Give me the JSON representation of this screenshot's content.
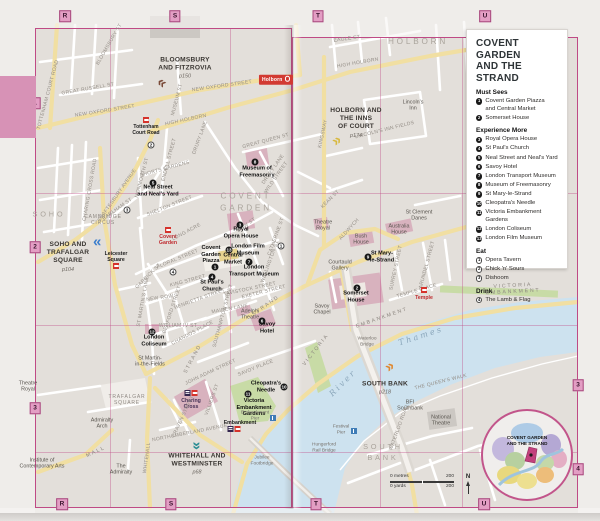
{
  "legend": {
    "title": "COVENT GARDEN\nAND THE STRAND",
    "sections": [
      {
        "heading": "Must Sees",
        "marker_style": "filled",
        "items": [
          {
            "num": "1",
            "label": "Covent Garden Piazza\nand Central Market"
          },
          {
            "num": "2",
            "label": "Somerset House"
          }
        ]
      },
      {
        "heading": "Experience More",
        "marker_style": "filled",
        "items": [
          {
            "num": "3",
            "label": "Royal Opera House"
          },
          {
            "num": "4",
            "label": "St Paul's Church"
          },
          {
            "num": "5",
            "label": "Neal Street and Neal's Yard"
          },
          {
            "num": "6",
            "label": "Savoy Hotel"
          },
          {
            "num": "7",
            "label": "London Transport Museum"
          },
          {
            "num": "8",
            "label": "Museum of Freemasonry"
          },
          {
            "num": "9",
            "label": "St Mary-le-Strand"
          },
          {
            "num": "10",
            "label": "Cleopatra's Needle"
          },
          {
            "num": "11",
            "label": "Victoria Embankment Gardens"
          },
          {
            "num": "12",
            "label": "London Coliseum"
          },
          {
            "num": "13",
            "label": "London Film Museum"
          }
        ]
      },
      {
        "heading": "Eat",
        "marker_style": "outline",
        "items": [
          {
            "num": "1",
            "label": "Opera Tavern"
          },
          {
            "num": "2",
            "label": "Chick 'n' Sours"
          },
          {
            "num": "3",
            "label": "Dishoom"
          }
        ]
      },
      {
        "heading": "Drink",
        "marker_style": "outline",
        "items": [
          {
            "num": "4",
            "label": "The Lamb & Flag"
          }
        ]
      }
    ]
  },
  "scale": {
    "metres_label": "0 metres",
    "metres_value": "200",
    "yards_label": "0 yards",
    "yards_value": "200",
    "north_label": "N"
  },
  "inset": {
    "label": "COVENT GARDEN\nAND THE STRAND"
  },
  "colors": {
    "grid_pink": "#bf4a85",
    "marker_pink": "#e39ec4",
    "river_blue": "#cde2ef",
    "road_yellow": "#f1dfa2",
    "park_green": "#c8dba6",
    "building_pink": "#d7aebc"
  },
  "grid_markers": [
    {
      "label": "R",
      "x": 65,
      "y": 16
    },
    {
      "label": "S",
      "x": 175,
      "y": 16
    },
    {
      "label": "T",
      "x": 318,
      "y": 16
    },
    {
      "label": "U",
      "x": 485,
      "y": 16
    },
    {
      "label": "R",
      "x": 62,
      "y": 504
    },
    {
      "label": "S",
      "x": 171,
      "y": 504
    },
    {
      "label": "T",
      "x": 316,
      "y": 504
    },
    {
      "label": "U",
      "x": 484,
      "y": 504
    },
    {
      "label": "1",
      "x": 35,
      "y": 103
    },
    {
      "label": "2",
      "x": 35,
      "y": 247
    },
    {
      "label": "3",
      "x": 35,
      "y": 408
    },
    {
      "label": "3",
      "x": 578,
      "y": 385
    },
    {
      "label": "4",
      "x": 578,
      "y": 469
    }
  ],
  "chapters": [
    {
      "title": "BLOOMSBURY\nAND FITZROVIA",
      "page": "p150",
      "x": 185,
      "y": 68,
      "arrow": {
        "x": 162,
        "y": 84,
        "rot": -145,
        "color": "#7a4a38"
      }
    },
    {
      "title": "HOLBORN AND\nTHE INNS\nOF COURT",
      "page": "p174",
      "x": 356,
      "y": 123,
      "arrow": {
        "x": 336,
        "y": 141,
        "rot": -35,
        "color": "#d8b93f"
      }
    },
    {
      "title": "SOHO AND\nTRAFALGAR\nSQUARE",
      "page": "p104",
      "x": 68,
      "y": 257,
      "arrow": {
        "x": 98,
        "y": 243,
        "rot": 180,
        "color": "#3b7ecd"
      }
    },
    {
      "title": "WHITEHALL AND\nWESTMINSTER",
      "page": "p68",
      "x": 197,
      "y": 464,
      "arrow": {
        "x": 197,
        "y": 445,
        "rot": 90,
        "color": "#2b8d94"
      }
    },
    {
      "title": "SOUTH BANK",
      "page": "p218",
      "x": 385,
      "y": 388,
      "arrow": {
        "x": 389,
        "y": 367,
        "rot": -35,
        "color": "#df8830"
      }
    }
  ],
  "markers": [
    {
      "num": "1",
      "kind": "sight",
      "x": 215,
      "y": 267
    },
    {
      "num": "2",
      "kind": "sight",
      "x": 357,
      "y": 288
    },
    {
      "num": "3",
      "kind": "sight",
      "x": 240,
      "y": 225
    },
    {
      "num": "4",
      "kind": "sight",
      "x": 212,
      "y": 277
    },
    {
      "num": "5",
      "kind": "sight",
      "x": 153,
      "y": 183
    },
    {
      "num": "6",
      "kind": "sight",
      "x": 262,
      "y": 321
    },
    {
      "num": "7",
      "kind": "sight",
      "x": 249,
      "y": 262
    },
    {
      "num": "8",
      "kind": "sight",
      "x": 255,
      "y": 162
    },
    {
      "num": "9",
      "kind": "sight",
      "x": 368,
      "y": 257
    },
    {
      "num": "10",
      "kind": "sight",
      "x": 284,
      "y": 387
    },
    {
      "num": "11",
      "kind": "sight",
      "x": 248,
      "y": 394
    },
    {
      "num": "12",
      "kind": "sight",
      "x": 152,
      "y": 332
    },
    {
      "num": "13",
      "kind": "sight",
      "x": 229,
      "y": 250
    },
    {
      "num": "1",
      "kind": "eat",
      "x": 281,
      "y": 246
    },
    {
      "num": "2",
      "kind": "eat",
      "x": 151,
      "y": 145
    },
    {
      "num": "3",
      "kind": "eat",
      "x": 127,
      "y": 210
    },
    {
      "num": "4",
      "kind": "eat",
      "x": 173,
      "y": 272
    }
  ],
  "station_icons": [
    {
      "x": 146,
      "y": 120,
      "types": [
        "tube"
      ],
      "name": "tottenham-court-road-station"
    },
    {
      "x": 168,
      "y": 230,
      "types": [
        "tube"
      ],
      "name": "covent-garden-station"
    },
    {
      "x": 116,
      "y": 266,
      "types": [
        "tube"
      ],
      "name": "leicester-square-station"
    },
    {
      "x": 191,
      "y": 393,
      "types": [
        "rail",
        "tube"
      ],
      "name": "charing-cross-station"
    },
    {
      "x": 234,
      "y": 429,
      "types": [
        "rail",
        "tube"
      ],
      "name": "embankment-station"
    },
    {
      "x": 273,
      "y": 418,
      "types": [
        "pier"
      ],
      "name": "embankment-pier-icon"
    },
    {
      "x": 424,
      "y": 290,
      "types": [
        "tube"
      ],
      "name": "temple-station"
    },
    {
      "x": 354,
      "y": 431,
      "types": [
        "pier"
      ],
      "name": "festival-pier-icon"
    }
  ],
  "labels": [
    {
      "text": "SOHO",
      "x": 49,
      "y": 214,
      "cls": "area area-sm",
      "name": "area-label-soho"
    },
    {
      "text": "COVENT\nGARDEN",
      "x": 246,
      "y": 203,
      "cls": "area",
      "name": "area-label-covent-garden"
    },
    {
      "text": "HOLBORN",
      "x": 418,
      "y": 42,
      "cls": "area",
      "name": "area-label-holborn"
    },
    {
      "text": "SOUTH\nBANK",
      "x": 383,
      "y": 452,
      "cls": "area area-sm",
      "name": "area-label-south-bank"
    },
    {
      "text": "River",
      "x": 343,
      "y": 383,
      "cls": "river",
      "rot": -45,
      "name": "river-label"
    },
    {
      "text": "Thames",
      "x": 421,
      "y": 336,
      "cls": "river",
      "rot": -18,
      "name": "river-label"
    },
    {
      "text": "Covent\nGarden\nPiazza",
      "x": 211,
      "y": 255,
      "cls": "sight"
    },
    {
      "text": "Central\nMarket",
      "x": 233,
      "y": 259,
      "cls": "sight"
    },
    {
      "text": "Somerset\nHouse",
      "x": 356,
      "y": 297,
      "cls": "sight"
    },
    {
      "text": "Royal\nOpera House",
      "x": 241,
      "y": 233,
      "cls": "sight"
    },
    {
      "text": "St Paul's\nChurch",
      "x": 212,
      "y": 286,
      "cls": "sight"
    },
    {
      "text": "Neal Street\nand Neal's Yard",
      "x": 158,
      "y": 191,
      "cls": "sight"
    },
    {
      "text": "Savoy\nHotel",
      "x": 267,
      "y": 328,
      "cls": "sight"
    },
    {
      "text": "London\nTransport Museum",
      "x": 254,
      "y": 271,
      "cls": "sight"
    },
    {
      "text": "Museum of\nFreemasonry",
      "x": 257,
      "y": 172,
      "cls": "sight"
    },
    {
      "text": "St Mary-\nle-Strand",
      "x": 382,
      "y": 257,
      "cls": "sight"
    },
    {
      "text": "Cleopatra's\nNeedle",
      "x": 266,
      "y": 387,
      "cls": "sight"
    },
    {
      "text": "Victoria\nEmbankment\nGardens",
      "x": 254,
      "y": 408,
      "cls": "sight"
    },
    {
      "text": "London\nColiseum",
      "x": 154,
      "y": 341,
      "cls": "sight"
    },
    {
      "text": "London Film\nMuseum",
      "x": 248,
      "y": 250,
      "cls": "sight"
    },
    {
      "text": "Holborn",
      "x": 276,
      "y": 80,
      "cls": "tube-badge",
      "name": "holborn-station"
    },
    {
      "text": "Tottenham\nCourt Road",
      "x": 146,
      "y": 131,
      "cls": "station",
      "size": 5
    },
    {
      "text": "Covent\nGarden",
      "x": 168,
      "y": 240,
      "cls": "station station-red"
    },
    {
      "text": "Leicester\nSquare",
      "x": 116,
      "y": 257,
      "cls": "station"
    },
    {
      "text": "Charing\nCross",
      "x": 191,
      "y": 404,
      "cls": "station station-purple"
    },
    {
      "text": "Embankment",
      "x": 240,
      "y": 423,
      "cls": "station"
    },
    {
      "text": "Embankment\nPier",
      "x": 255,
      "y": 416,
      "cls": "pier-lbl"
    },
    {
      "text": "Temple",
      "x": 424,
      "y": 298,
      "cls": "station station-red"
    },
    {
      "text": "Festival\nPier",
      "x": 341,
      "y": 430,
      "cls": "pier-lbl"
    },
    {
      "text": "Waterloo\nBridge",
      "x": 367,
      "y": 342,
      "cls": "pier-lbl"
    },
    {
      "text": "Jubilee\nFootbridge",
      "x": 262,
      "y": 461,
      "cls": "pier-lbl"
    },
    {
      "text": "Hungerford\nRail Bridge",
      "x": 324,
      "y": 448,
      "cls": "pier-lbl"
    },
    {
      "text": "Lincoln's\nInn",
      "x": 413,
      "y": 106,
      "cls": "poi"
    },
    {
      "text": "St Clement\nDanes",
      "x": 419,
      "y": 216,
      "cls": "poi"
    },
    {
      "text": "Theatre\nRoyal",
      "x": 323,
      "y": 226,
      "cls": "poi"
    },
    {
      "text": "Bush\nHouse",
      "x": 361,
      "y": 240,
      "cls": "poi"
    },
    {
      "text": "Australia\nHouse",
      "x": 399,
      "y": 230,
      "cls": "poi"
    },
    {
      "text": "Courtauld\nGallery",
      "x": 340,
      "y": 266,
      "cls": "poi"
    },
    {
      "text": "Savoy\nChapel",
      "x": 322,
      "y": 310,
      "cls": "poi"
    },
    {
      "text": "Adelphi\nTheatre",
      "x": 250,
      "y": 315,
      "cls": "poi"
    },
    {
      "text": "St Martin-\nin-the-Fields",
      "x": 150,
      "y": 362,
      "cls": "poi"
    },
    {
      "text": "Admiralty\nArch",
      "x": 102,
      "y": 424,
      "cls": "poi"
    },
    {
      "text": "The\nAdmiralty",
      "x": 121,
      "y": 470,
      "cls": "poi"
    },
    {
      "text": "Institute of\nContemporary Arts",
      "x": 42,
      "y": 464,
      "cls": "poi"
    },
    {
      "text": "Theatre\nRoyal",
      "x": 28,
      "y": 387,
      "cls": "poi"
    },
    {
      "text": "BFI\nSouthbank",
      "x": 410,
      "y": 406,
      "cls": "poi"
    },
    {
      "text": "National\nTheatre",
      "x": 441,
      "y": 421,
      "cls": "poi"
    },
    {
      "text": "TRAFALGAR\nSQUARE",
      "x": 127,
      "y": 401,
      "cls": "poi-caps"
    },
    {
      "text": "CAMBRIDGE\nCIRCUS",
      "x": 103,
      "y": 221,
      "cls": "poi-caps"
    },
    {
      "text": "NEW OXFORD STREET",
      "x": 105,
      "y": 112,
      "cls": "street",
      "rot": -9
    },
    {
      "text": "NEW OXFORD STREET",
      "x": 222,
      "y": 87,
      "cls": "street",
      "rot": -8
    },
    {
      "text": "HIGH HOLBORN",
      "x": 186,
      "y": 121,
      "cls": "street",
      "rot": -12
    },
    {
      "text": "HIGH HOLBORN",
      "x": 358,
      "y": 64,
      "cls": "street",
      "rot": -10
    },
    {
      "text": "TOTTENHAM COURT ROAD",
      "x": 49,
      "y": 95,
      "cls": "street",
      "rot": -75
    },
    {
      "text": "BLOOMSBURY ST",
      "x": 110,
      "y": 45,
      "cls": "street",
      "rot": -60
    },
    {
      "text": "GREAT RUSSELL ST",
      "x": 88,
      "y": 90,
      "cls": "street",
      "rot": -10
    },
    {
      "text": "MUSEUM ST",
      "x": 178,
      "y": 100,
      "cls": "street",
      "rot": -75
    },
    {
      "text": "SHAFTESBURY AVENUE",
      "x": 118,
      "y": 196,
      "cls": "street",
      "rot": -55
    },
    {
      "text": "CHARING CROSS ROAD",
      "x": 91,
      "y": 190,
      "cls": "street",
      "rot": -80
    },
    {
      "text": "EARLHAM ST",
      "x": 118,
      "y": 210,
      "cls": "street",
      "rot": -35
    },
    {
      "text": "MONMOUTH ST",
      "x": 143,
      "y": 178,
      "cls": "street",
      "rot": -75
    },
    {
      "text": "ENDELL STREET",
      "x": 170,
      "y": 160,
      "cls": "street",
      "rot": -75
    },
    {
      "text": "DRURY LANE",
      "x": 201,
      "y": 138,
      "cls": "street",
      "rot": -70
    },
    {
      "text": "DRURY LANE",
      "x": 274,
      "y": 170,
      "cls": "street",
      "rot": -55
    },
    {
      "text": "SHORTS GARDENS",
      "x": 165,
      "y": 170,
      "cls": "street",
      "rot": -15
    },
    {
      "text": "SHELTON STREET",
      "x": 170,
      "y": 207,
      "cls": "street",
      "rot": -22
    },
    {
      "text": "LONG ACRE",
      "x": 187,
      "y": 233,
      "cls": "street",
      "rot": -28
    },
    {
      "text": "BOW ST",
      "x": 247,
      "y": 226,
      "cls": "street",
      "rot": -35
    },
    {
      "text": "WILD STREET",
      "x": 277,
      "y": 178,
      "cls": "street",
      "rot": -55
    },
    {
      "text": "GREAT QUEEN ST",
      "x": 266,
      "y": 142,
      "cls": "street",
      "rot": -15
    },
    {
      "text": "KINGSWAY",
      "x": 324,
      "y": 134,
      "cls": "street",
      "rot": -78
    },
    {
      "text": "CATHERINE ST",
      "x": 277,
      "y": 237,
      "cls": "street",
      "rot": -70
    },
    {
      "text": "WELLINGTON ST",
      "x": 271,
      "y": 262,
      "cls": "street",
      "rot": -70
    },
    {
      "text": "ST MARTIN'S LANE",
      "x": 144,
      "y": 302,
      "cls": "street",
      "rot": -80
    },
    {
      "text": "GARRICK ST",
      "x": 149,
      "y": 277,
      "cls": "street",
      "rot": -45
    },
    {
      "text": "NEW ROW",
      "x": 160,
      "y": 299,
      "cls": "street",
      "rot": -8
    },
    {
      "text": "BEDFORD STREET",
      "x": 173,
      "y": 310,
      "cls": "street",
      "rot": -72
    },
    {
      "text": "KING STREET",
      "x": 188,
      "y": 282,
      "cls": "street",
      "rot": -15
    },
    {
      "text": "FLORAL STREET",
      "x": 178,
      "y": 260,
      "cls": "street",
      "rot": -22
    },
    {
      "text": "HENRIETTA STREET",
      "x": 200,
      "y": 300,
      "cls": "street",
      "rot": -20
    },
    {
      "text": "SOUTHAMPTON STREET",
      "x": 224,
      "y": 316,
      "cls": "street",
      "rot": -75
    },
    {
      "text": "MAIDEN LANE",
      "x": 230,
      "y": 310,
      "cls": "street",
      "rot": -10
    },
    {
      "text": "TAVISTOCK STREET",
      "x": 250,
      "y": 290,
      "cls": "street",
      "rot": -12
    },
    {
      "text": "EXETER STREET",
      "x": 264,
      "y": 293,
      "cls": "street",
      "rot": -14
    },
    {
      "text": "STRAND",
      "x": 193,
      "y": 359,
      "cls": "street sp",
      "rot": -62
    },
    {
      "text": "STRAND",
      "x": 266,
      "y": 306,
      "cls": "street sp",
      "rot": -35
    },
    {
      "text": "WILLIAM IV ST",
      "x": 178,
      "y": 327,
      "cls": "street"
    },
    {
      "text": "CHANDOS PLACE",
      "x": 193,
      "y": 334,
      "cls": "street",
      "rot": -28
    },
    {
      "text": "WHITEHALL",
      "x": 148,
      "y": 458,
      "cls": "street",
      "rot": -82
    },
    {
      "text": "NORTHUMBERLAND AVENUE",
      "x": 190,
      "y": 434,
      "cls": "street",
      "rot": -11
    },
    {
      "text": "CRAVEN STREET",
      "x": 184,
      "y": 417,
      "cls": "street",
      "rot": -65
    },
    {
      "text": "VILLIERS ST",
      "x": 213,
      "y": 400,
      "cls": "street",
      "rot": -70
    },
    {
      "text": "JOHN ADAM STREET",
      "x": 211,
      "y": 373,
      "cls": "street",
      "rot": -25
    },
    {
      "text": "SAVOY PLACE",
      "x": 256,
      "y": 369,
      "cls": "street",
      "rot": -22
    },
    {
      "text": "ALDWYCH",
      "x": 350,
      "y": 230,
      "cls": "street",
      "rot": -48
    },
    {
      "text": "KEAN ST",
      "x": 331,
      "y": 200,
      "cls": "street",
      "rot": -45
    },
    {
      "text": "LINCOLN'S INN FIELDS",
      "x": 385,
      "y": 131,
      "cls": "street",
      "rot": -14
    },
    {
      "text": "EAGLE ST",
      "x": 347,
      "y": 40,
      "cls": "street",
      "rot": -8
    },
    {
      "text": "SURREY STREET",
      "x": 397,
      "y": 268,
      "cls": "street",
      "rot": -78
    },
    {
      "text": "ARUNDEL STREET",
      "x": 428,
      "y": 265,
      "cls": "street",
      "rot": -75
    },
    {
      "text": "TEMPLE PLACE",
      "x": 417,
      "y": 292,
      "cls": "street",
      "rot": -16
    },
    {
      "text": "EMBANKMENT",
      "x": 382,
      "y": 318,
      "cls": "street sp",
      "rot": -19
    },
    {
      "text": "VICTORIA",
      "x": 316,
      "y": 350,
      "cls": "street sp",
      "rot": -52
    },
    {
      "text": "VICTORIA EMBANKMENT",
      "x": 513,
      "y": 289,
      "cls": "street sp",
      "rot": -3
    },
    {
      "text": "THE QUEEN'S WALK",
      "x": 441,
      "y": 383,
      "cls": "street",
      "rot": -14
    },
    {
      "text": "WATERLOO ROAD",
      "x": 400,
      "y": 428,
      "cls": "street",
      "rot": -70
    },
    {
      "text": "MALL",
      "x": 96,
      "y": 452,
      "cls": "street sp",
      "rot": -25
    }
  ]
}
